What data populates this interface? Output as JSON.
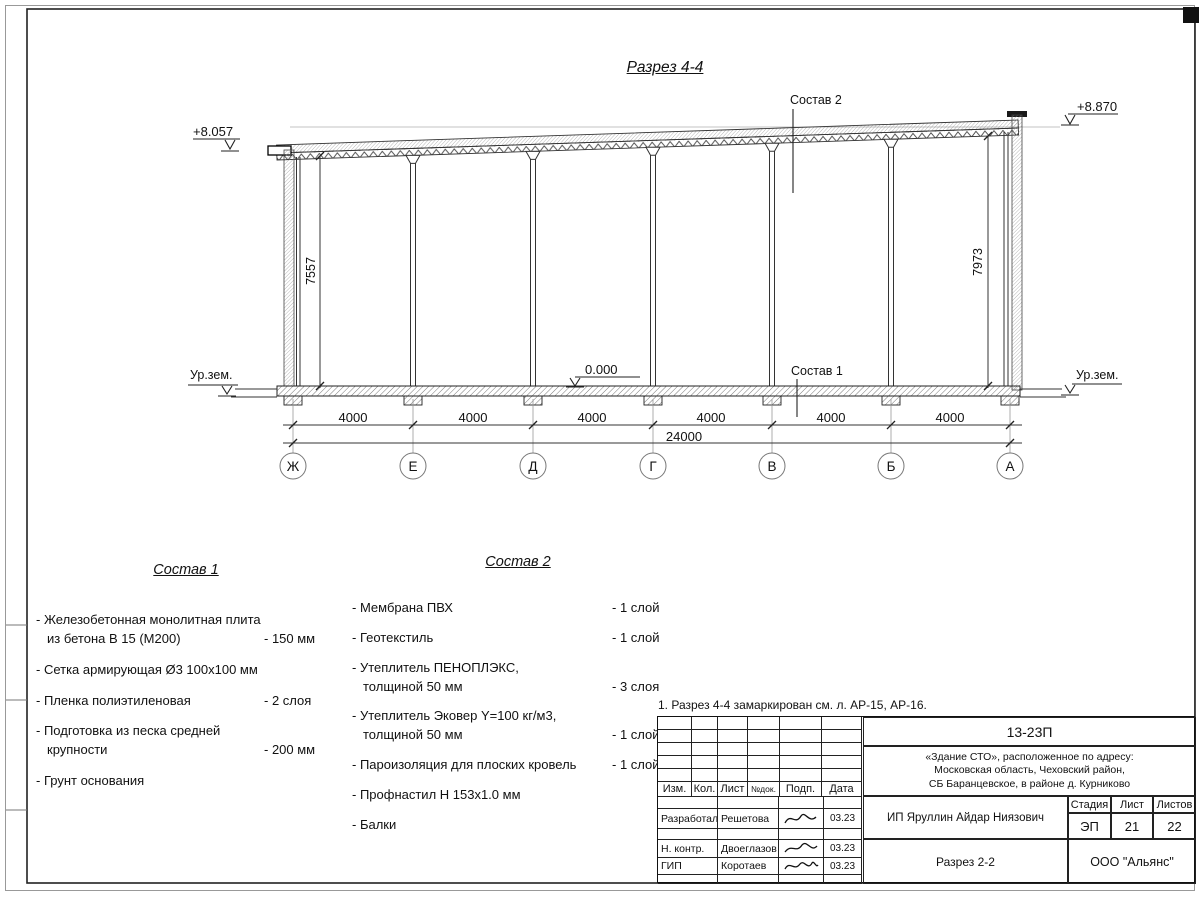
{
  "sheet": {
    "note": "1. Разрез 4-4 замаркирован см. л. АР-15, АР-16."
  },
  "section": {
    "title": "Разрез 4-4",
    "elev_left_top": "+8.057",
    "elev_right_top": "+8.870",
    "elev_floor": "0.000",
    "ground_left": "Ур.зем.",
    "ground_right": "Ур.зем.",
    "leader_roof": "Состав 2",
    "leader_floor": "Состав 1",
    "dim_left_height": "7557",
    "dim_right_height": "7973",
    "dim_total": "24000",
    "bays": [
      "4000",
      "4000",
      "4000",
      "4000",
      "4000",
      "4000"
    ],
    "axes": [
      "Ж",
      "Е",
      "Д",
      "Г",
      "В",
      "Б",
      "А"
    ]
  },
  "comp1": {
    "title": "Состав 1",
    "items": [
      {
        "name": "- Железобетонная  монолитная плита\nиз бетона В 15 (М200)",
        "value": "- 150 мм"
      },
      {
        "name": "- Сетка армирующая Ø3 100x100 мм",
        "value": ""
      },
      {
        "name": "- Пленка полиэтиленовая",
        "value": "-  2 слоя"
      },
      {
        "name": "- Подготовка из песка средней\nкрупности",
        "value": "- 200 мм"
      },
      {
        "name": "- Грунт основания",
        "value": ""
      }
    ]
  },
  "comp2": {
    "title": "Состав 2",
    "items": [
      {
        "name": "- Мембрана ПВХ",
        "value": "- 1 слой"
      },
      {
        "name": "- Геотекстиль",
        "value": "- 1 слой"
      },
      {
        "name": "- Утеплитель ПЕНОПЛЭКС,\nтолщиной 50 мм",
        "value": "- 3 слоя"
      },
      {
        "name": "- Утеплитель Эковер Y=100 кг/м3,\nтолщиной 50 мм",
        "value": "- 1 слой"
      },
      {
        "name": "- Пароизоляция для плоских кровель",
        "value": "- 1 слой"
      },
      {
        "name": "- Профнастил Н 153х1.0 мм",
        "value": ""
      },
      {
        "name": "- Балки",
        "value": ""
      }
    ]
  },
  "titleblock": {
    "doc_number": "13-23П",
    "object_address": "«Здание СТО», расположенное по адресу:\nМосковская область, Чеховский район,\nСБ Баранцевское, в районе д. Курниково",
    "columns": [
      "Изм.",
      "Кол.",
      "Лист",
      "№док.",
      "Подп.",
      "Дата"
    ],
    "rows": [
      {
        "role": "Разработал",
        "name": "Решетова",
        "date": "03.23"
      },
      {
        "role": "Н. контр.",
        "name": "Двоеглазов",
        "date": "03.23"
      },
      {
        "role": "ГИП",
        "name": "Коротаев",
        "date": "03.23"
      }
    ],
    "client": "ИП Яруллин Айдар Ниязович",
    "stage_label": "Стадия",
    "sheet_label": "Лист",
    "sheets_label": "Листов",
    "stage": "ЭП",
    "sheet": "21",
    "sheets": "22",
    "sheet_title": "Разрез 2-2",
    "company": "ООО \"Альянс\""
  }
}
